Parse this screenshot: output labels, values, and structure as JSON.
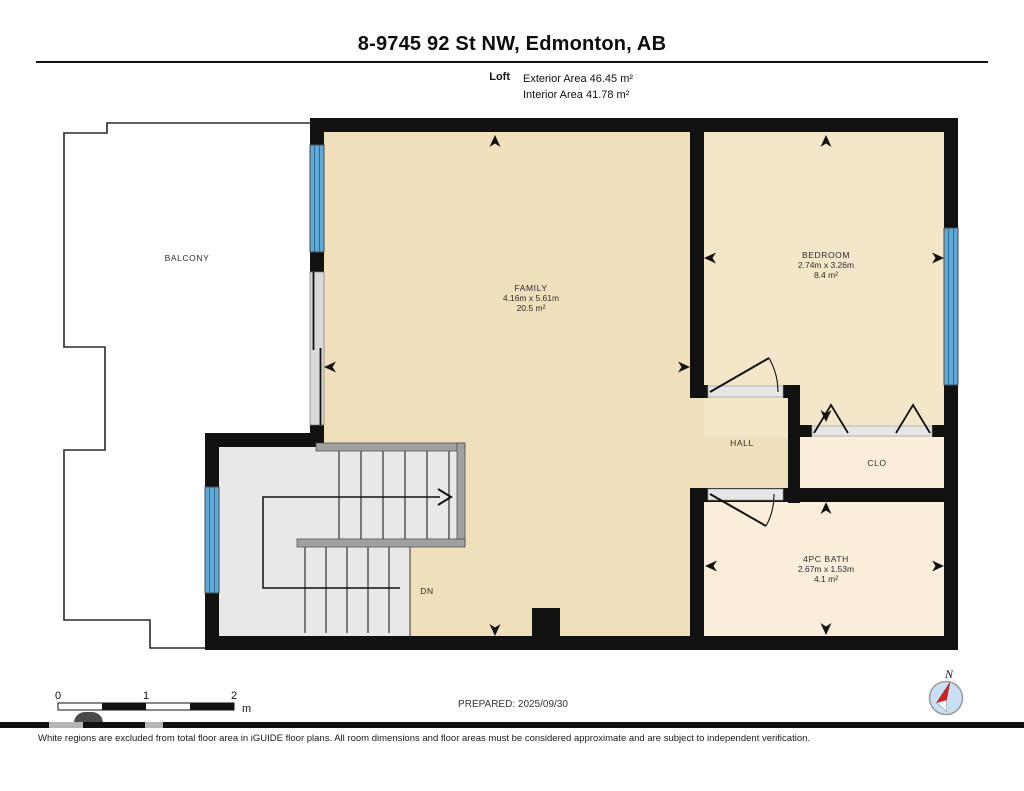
{
  "header": {
    "title": "8-9745 92 St NW, Edmonton, AB",
    "floor_label": "Loft",
    "exterior_area": "Exterior Area 46.45 m²",
    "interior_area": "Interior Area 41.78 m²"
  },
  "rooms": {
    "family": {
      "name": "FAMILY",
      "dimensions": "4.16m x 5.61m",
      "area": "20.5 m²"
    },
    "bedroom": {
      "name": "BEDROOM",
      "dimensions": "2.74m x 3.26m",
      "area": "8.4 m²"
    },
    "bath": {
      "name": "4PC BATH",
      "dimensions": "2.67m x 1.53m",
      "area": "4.1 m²"
    },
    "hall": {
      "name": "HALL"
    },
    "closet": {
      "name": "CLO"
    },
    "balcony": {
      "name": "BALCONY"
    },
    "stairs": {
      "direction_label": "DN"
    }
  },
  "footer": {
    "scale": {
      "ticks": [
        "0",
        "1",
        "2"
      ],
      "unit": "m"
    },
    "prepared": "PREPARED: 2025/09/30",
    "compass_label": "N",
    "disclaimer": "White regions are excluded from total floor area in iGUIDE floor plans. All room dimensions and floor areas must be considered approximate and are subject to independent verification."
  },
  "colors": {
    "wall": "#111111",
    "floor_main": "#F0DFBB",
    "floor_bedroom": "#F4E6C8",
    "floor_light": "#FAEEDA",
    "stairs": "#E8E8E8",
    "window": "#5FA9D6",
    "compass_needle": "#D21F1F",
    "compass_face": "#C9E0F4"
  }
}
